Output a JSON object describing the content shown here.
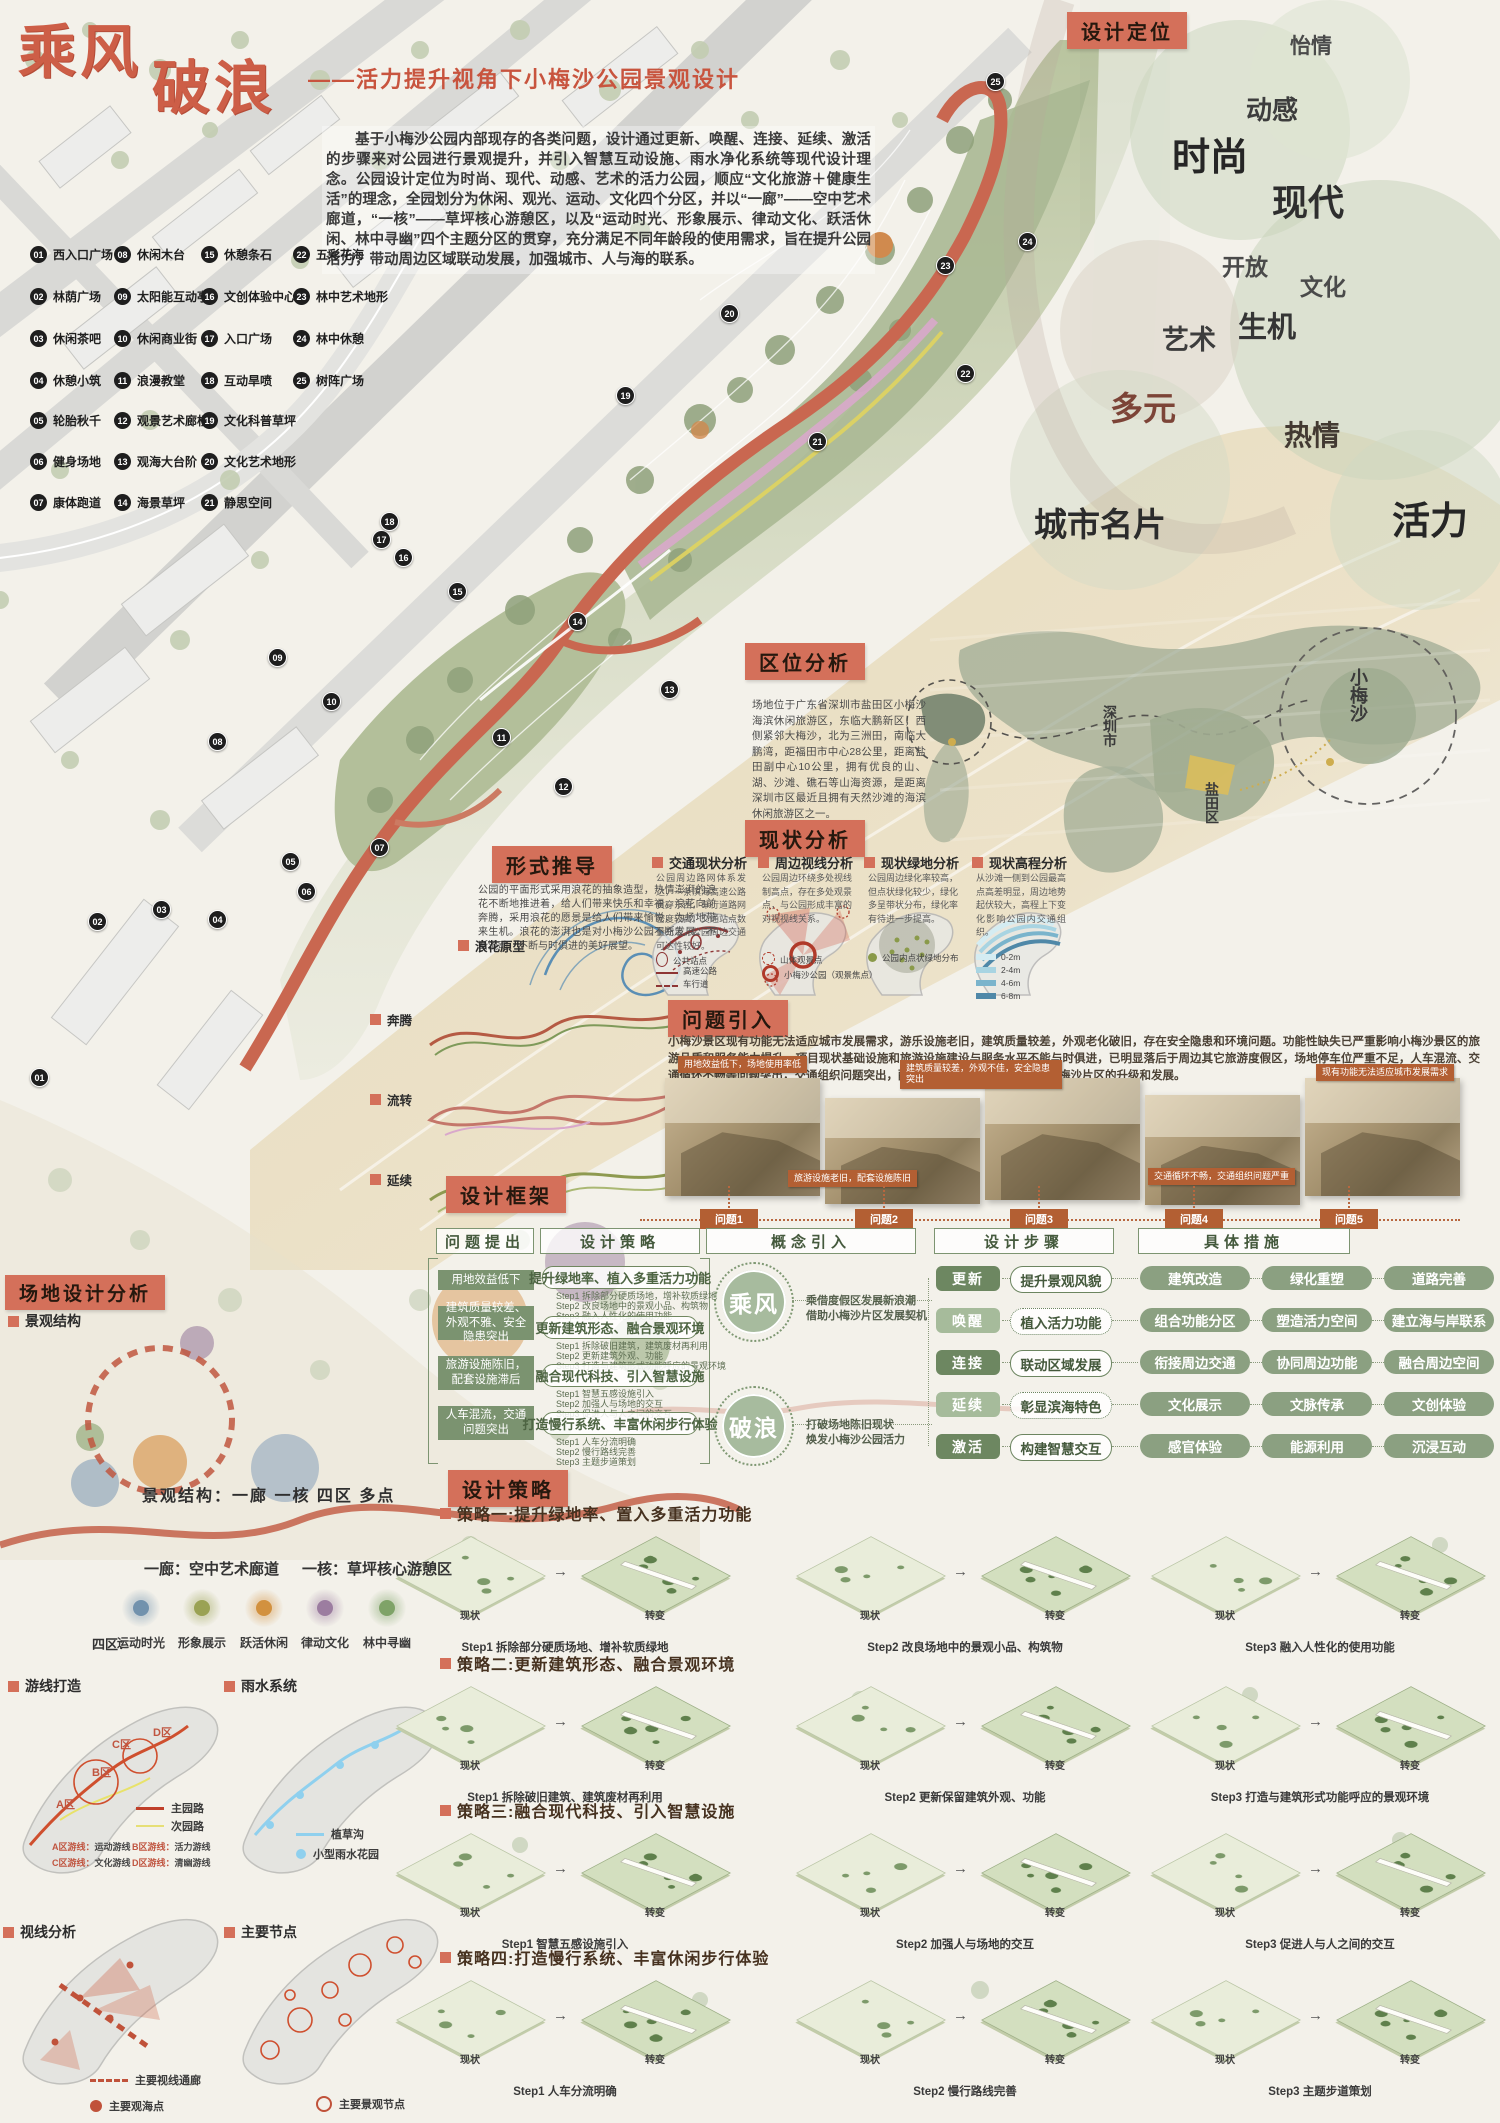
{
  "poster": {
    "title1": "乘风",
    "title2": "破浪",
    "subtitle": "——活力提升视角下小梅沙公园景观设计",
    "intro": "基于小梅沙公园内部现存的各类问题，设计通过更新、唤醒、连接、延续、激活的步骤来对公园进行景观提升，并引入智慧互动设施、雨水净化系统等现代设计理念。公园设计定位为时尚、现代、动感、艺术的活力公园，顺应“文化旅游＋健康生活”的理念，全园划分为休闲、观光、运动、文化四个分区，并以“一廊”——空中艺术廊道，“一核”——草坪核心游憩区，以及“运动时光、形象展示、律动文化、跃活休闲、林中寻幽”四个主题分区的贯穿，充分满足不同年龄段的使用需求，旨在提升公园活力，带动周边区域联动发展，加强城市、人与海的联系。"
  },
  "legend": {
    "items": [
      {
        "num": "01",
        "label": "西入口广场"
      },
      {
        "num": "02",
        "label": "林荫广场"
      },
      {
        "num": "03",
        "label": "休闲茶吧"
      },
      {
        "num": "04",
        "label": "休憩小筑"
      },
      {
        "num": "05",
        "label": "轮胎秋千"
      },
      {
        "num": "06",
        "label": "健身场地"
      },
      {
        "num": "07",
        "label": "康体跑道"
      },
      {
        "num": "08",
        "label": "休闲木台"
      },
      {
        "num": "09",
        "label": "太阳能互动亭"
      },
      {
        "num": "10",
        "label": "休闲商业街"
      },
      {
        "num": "11",
        "label": "浪漫教堂"
      },
      {
        "num": "12",
        "label": "观景艺术廊桥"
      },
      {
        "num": "13",
        "label": "观海大台阶"
      },
      {
        "num": "14",
        "label": "海景草坪"
      },
      {
        "num": "15",
        "label": "休憩条石"
      },
      {
        "num": "16",
        "label": "文创体验中心"
      },
      {
        "num": "17",
        "label": "入口广场"
      },
      {
        "num": "18",
        "label": "互动旱喷"
      },
      {
        "num": "19",
        "label": "文化科普草坪"
      },
      {
        "num": "20",
        "label": "文化艺术地形"
      },
      {
        "num": "21",
        "label": "静思空间"
      },
      {
        "num": "22",
        "label": "五彩花海"
      },
      {
        "num": "23",
        "label": "林中艺术地形"
      },
      {
        "num": "24",
        "label": "林中休憩"
      },
      {
        "num": "25",
        "label": "树阵广场"
      }
    ]
  },
  "positioning": {
    "tag": "设计定位",
    "keywords": [
      {
        "text": "怡情",
        "x": 1290,
        "y": 30,
        "size": 21,
        "color": "#4a4a4a"
      },
      {
        "text": "动感",
        "x": 1246,
        "y": 90,
        "size": 26,
        "color": "#3d3d3d"
      },
      {
        "text": "时尚",
        "x": 1172,
        "y": 126,
        "size": 38,
        "color": "#262626"
      },
      {
        "text": "现代",
        "x": 1272,
        "y": 174,
        "size": 36,
        "color": "#2e2e2e"
      },
      {
        "text": "开放",
        "x": 1222,
        "y": 248,
        "size": 23,
        "color": "#4a4a4a"
      },
      {
        "text": "文化",
        "x": 1300,
        "y": 268,
        "size": 23,
        "color": "#4a4a4a"
      },
      {
        "text": "生机",
        "x": 1238,
        "y": 304,
        "size": 29,
        "color": "#353535"
      },
      {
        "text": "艺术",
        "x": 1162,
        "y": 318,
        "size": 27,
        "color": "#3d3d3d"
      },
      {
        "text": "多元",
        "x": 1110,
        "y": 382,
        "size": 33,
        "color": "#7c4437"
      },
      {
        "text": "热情",
        "x": 1284,
        "y": 414,
        "size": 28,
        "color": "#433a32"
      },
      {
        "text": "城市名片",
        "x": 1034,
        "y": 498,
        "size": 33,
        "color": "#2b2b2b"
      },
      {
        "text": "活力",
        "x": 1392,
        "y": 490,
        "size": 38,
        "color": "#262626"
      }
    ]
  },
  "map_markers": [
    {
      "num": "01",
      "x": 30,
      "y": 1068
    },
    {
      "num": "02",
      "x": 88,
      "y": 912
    },
    {
      "num": "03",
      "x": 152,
      "y": 900
    },
    {
      "num": "04",
      "x": 208,
      "y": 910
    },
    {
      "num": "05",
      "x": 281,
      "y": 852
    },
    {
      "num": "06",
      "x": 297,
      "y": 882
    },
    {
      "num": "07",
      "x": 370,
      "y": 838
    },
    {
      "num": "08",
      "x": 208,
      "y": 732
    },
    {
      "num": "09",
      "x": 268,
      "y": 648
    },
    {
      "num": "10",
      "x": 322,
      "y": 692
    },
    {
      "num": "11",
      "x": 492,
      "y": 728
    },
    {
      "num": "12",
      "x": 554,
      "y": 777
    },
    {
      "num": "13",
      "x": 660,
      "y": 680
    },
    {
      "num": "14",
      "x": 568,
      "y": 612
    },
    {
      "num": "15",
      "x": 448,
      "y": 582
    },
    {
      "num": "16",
      "x": 394,
      "y": 548
    },
    {
      "num": "17",
      "x": 372,
      "y": 530
    },
    {
      "num": "18",
      "x": 380,
      "y": 512
    },
    {
      "num": "19",
      "x": 616,
      "y": 386
    },
    {
      "num": "20",
      "x": 720,
      "y": 304
    },
    {
      "num": "21",
      "x": 808,
      "y": 432
    },
    {
      "num": "22",
      "x": 956,
      "y": 364
    },
    {
      "num": "23",
      "x": 936,
      "y": 256
    },
    {
      "num": "24",
      "x": 1018,
      "y": 232
    },
    {
      "num": "25",
      "x": 986,
      "y": 72
    }
  ],
  "location": {
    "tag": "区位分析",
    "text": "场地位于广东省深圳市盐田区小梅沙海滨休闲旅游区，东临大鹏新区，西侧紧邻大梅沙，北为三洲田，南临大鹏湾，距福田市中心28公里，距离盐田副中心10公里，拥有优良的山、湖、沙滩、礁石等山海资源，是距离深圳市区最近且拥有天然沙滩的海滨休闲旅游区之一。",
    "places": [
      {
        "name": "深圳市",
        "x": 1100,
        "y": 705,
        "size": 14
      },
      {
        "name": "盐田区",
        "x": 1202,
        "y": 782,
        "size": 14
      },
      {
        "name": "小梅沙",
        "x": 1345,
        "y": 668,
        "size": 18
      }
    ]
  },
  "form": {
    "tag": "形式推导",
    "text": "公园的平面形式采用浪花的抽象造型，热情澎湃的浪花不断地推进着，给人们带来快乐和幸福。浪花向前奔腾，采用浪花的愿景是给人们带来愉悦，为场地带来生机。浪花的澎湃也是对小梅沙公园不断发展、不断流动、不断与时俱进的美好展望。",
    "prototype": "浪花原型",
    "steps": [
      "奔腾",
      "流转",
      "延续"
    ]
  },
  "status": {
    "tag": "现状分析",
    "sections": [
      {
        "title": "交通现状分析",
        "desc": "公园周边路网体系发达，一条滨海高速公路贯穿东西，车行道路网密度较高，交通站点数量充足，公园周边交通可达性较好。",
        "legend": [
          {
            "sym": "ellipse",
            "label": "公共站点"
          },
          {
            "sym": "solid",
            "label": "高速公路"
          },
          {
            "sym": "dashed",
            "label": "车行道"
          }
        ]
      },
      {
        "title": "周边视线分析",
        "desc": "公园周边环绕多处视线制高点，存在多处观景点，与公园形成丰富的对视视线关系。",
        "legend": [
          {
            "sym": "dashcircle",
            "label": "山体观景点"
          },
          {
            "sym": "boldcircle",
            "label": "小梅沙公园（观景焦点）"
          }
        ]
      },
      {
        "title": "现状绿地分析",
        "desc": "公园周边绿化率较高，但点状绿化较少，绿化多呈带状分布，绿化率有待进一步提高。",
        "legend": [
          {
            "sym": "dot",
            "label": "公园内点状绿地分布"
          }
        ]
      },
      {
        "title": "现状高程分析",
        "desc": "从沙滩一侧到公园最高点高差明显，周边地势起伏较大，高程上下变化影响公园内交通组织。",
        "legend": [
          {
            "sym": "sw1",
            "label": "0-2m"
          },
          {
            "sym": "sw2",
            "label": "2-4m"
          },
          {
            "sym": "sw3",
            "label": "4-6m"
          },
          {
            "sym": "sw4",
            "label": "6-8m"
          }
        ]
      }
    ]
  },
  "problems": {
    "tag": "问题引入",
    "text": "小梅沙景区现有功能无法适应城市发展需求，游乐设施老旧，建筑质量较差，外观老化破旧，存在安全隐患和环境问题。功能性缺失已严重影响小梅沙景区的旅游品质和服务能力提升。项目现状基础设施和旅游设施建设与服务水平不能与时俱进，已明显落后于周边其它旅游度假区，场地停车位严重不足，人车混流、交通循环不畅等问题突出，交通组织问题突出，配套设施滞后等问题严重制约小梅沙片区的升级和发展。",
    "photo_tags": [
      {
        "text": "用地效益低下，场地使用率低",
        "x": 678,
        "y": 1056
      },
      {
        "text": "旅游设施老旧，配套设施陈旧",
        "x": 788,
        "y": 1170
      },
      {
        "text": "建筑质量较差，外观不佳，安全隐患突出",
        "x": 900,
        "y": 1060
      },
      {
        "text": "交通循环不畅，交通组织问题严重",
        "x": 1148,
        "y": 1168
      },
      {
        "text": "现有功能无法适应城市发展需求",
        "x": 1316,
        "y": 1064
      }
    ],
    "timeline": [
      "问题1",
      "问题2",
      "问题3",
      "问题4",
      "问题5"
    ]
  },
  "framework": {
    "tag": "设计框架",
    "columns": [
      "问题提出",
      "设计策略",
      "概念引入",
      "设计步骤",
      "具体措施"
    ],
    "problems": [
      "用地效益低下",
      "建筑质量较差、外观不雅、安全隐患突出",
      "旅游设施陈旧，配套设施滞后",
      "人车混流，交通问题突出"
    ],
    "strategies": [
      {
        "title": "提升绿地率、植入多重活力功能",
        "steps": [
          "Step1  拆除部分硬质场地，增补软质绿地",
          "Step2  改良场地中的景观小品、构筑物",
          "Step3  融入人性化的使用功能"
        ]
      },
      {
        "title": "更新建筑形态、融合景观环境",
        "steps": [
          "Step1  拆除破旧建筑，建筑废材再利用",
          "Step2  更新建筑外观、功能",
          "Step3  打造与建筑形式功能呼应的景观环境"
        ]
      },
      {
        "title": "融合现代科技、引入智慧设施",
        "steps": [
          "Step1  智慧五感设施引入",
          "Step2  加强人与场地的交互",
          "Step3  促进人与人之间的交互"
        ]
      },
      {
        "title": "打造慢行系统、丰富休闲步行体验",
        "steps": [
          "Step1  人车分流明确",
          "Step2  慢行路线完善",
          "Step3  主题步道策划"
        ]
      }
    ],
    "concepts": [
      {
        "name": "乘风",
        "lines": [
          "乘借度假区发展新浪潮",
          "借助小梅沙片区发展契机"
        ]
      },
      {
        "name": "破浪",
        "lines": [
          "打破场地陈旧现状",
          "焕发小梅沙公园活力"
        ]
      }
    ],
    "steps": [
      {
        "action": "更新",
        "result": "提升景观风貌"
      },
      {
        "action": "唤醒",
        "result": "植入活力功能"
      },
      {
        "action": "连接",
        "result": "联动区域发展"
      },
      {
        "action": "延续",
        "result": "彰显滨海特色"
      },
      {
        "action": "激活",
        "result": "构建智慧交互"
      }
    ],
    "measures": [
      "建筑改造",
      "绿化重塑",
      "道路完善",
      "组合功能分区",
      "塑造活力空间",
      "建立海与岸联系",
      "衔接周边交通",
      "协同周边功能",
      "融合周边空间",
      "文化展示",
      "文脉传承",
      "文创体验",
      "感官体验",
      "能源利用",
      "沉浸互动"
    ]
  },
  "strategy_section": {
    "tag": "设计策略",
    "state": "现状",
    "change": "转变",
    "rows": [
      {
        "title": "策略一:提升绿地率、置入多重活力功能",
        "captions": [
          "Step1 拆除部分硬质场地、增补软质绿地",
          "Step2 改良场地中的景观小品、构筑物",
          "Step3 融入人性化的使用功能"
        ]
      },
      {
        "title": "策略二:更新建筑形态、融合景观环境",
        "captions": [
          "Step1 拆除破旧建筑、建筑废材再利用",
          "Step2 更新保留建筑外观、功能",
          "Step3 打造与建筑形式功能呼应的景观环境"
        ]
      },
      {
        "title": "策略三:融合现代科技、引入智慧设施",
        "captions": [
          "Step1 智慧五感设施引入",
          "Step2 加强人与场地的交互",
          "Step3 促进人与人之间的交互"
        ]
      },
      {
        "title": "策略四:打造慢行系统、丰富休闲步行体验",
        "captions": [
          "Step1 人车分流明确",
          "Step2 慢行路线完善",
          "Step3 主题步道策划"
        ]
      }
    ]
  },
  "site": {
    "tag": "场地设计分析",
    "structure_label": "景观结构",
    "structure": "景观结构：一廊 一核 四区 多点",
    "corridor": "一廊：空中艺术廊道",
    "core": "一核：草坪核心游憩区",
    "zones_prefix": "四区：",
    "zones": [
      {
        "name": "运动时光",
        "color": "#7292ad"
      },
      {
        "name": "形象展示",
        "color": "#9aa254"
      },
      {
        "name": "跃活休闲",
        "color": "#d2913f"
      },
      {
        "name": "律动文化",
        "color": "#9c7da0"
      },
      {
        "name": "林中寻幽",
        "color": "#7fa368"
      }
    ],
    "sub1": "游线打造",
    "sub2": "雨水系统",
    "sub3": "视线分析",
    "sub4": "主要节点",
    "areas": [
      {
        "name": "A区",
        "x": 56,
        "y": 1796
      },
      {
        "name": "B区",
        "x": 92,
        "y": 1764
      },
      {
        "name": "C区",
        "x": 112,
        "y": 1736
      },
      {
        "name": "D区",
        "x": 153,
        "y": 1724
      }
    ],
    "route_legend": [
      {
        "sym": "red",
        "label": "主园路"
      },
      {
        "sym": "yellow",
        "label": "次园路"
      }
    ],
    "route_lines": [
      {
        "prefix": "A区游线：",
        "value": "运动游线"
      },
      {
        "prefix": "B区游线：",
        "value": "活力游线"
      },
      {
        "prefix": "C区游线：",
        "value": "文化游线"
      },
      {
        "prefix": "D区游线：",
        "value": "清幽游线"
      }
    ],
    "rain_legend": [
      {
        "sym": "blueline",
        "label": "植草沟"
      },
      {
        "sym": "bluedot",
        "label": "小型雨水花园"
      }
    ],
    "sight_legend": [
      {
        "sym": "dashred",
        "label": "主要视线通廊"
      },
      {
        "sym": "reddot",
        "label": "主要观海点"
      }
    ],
    "node_legend": [
      {
        "sym": "redcirc",
        "label": "主要景观节点"
      }
    ]
  }
}
